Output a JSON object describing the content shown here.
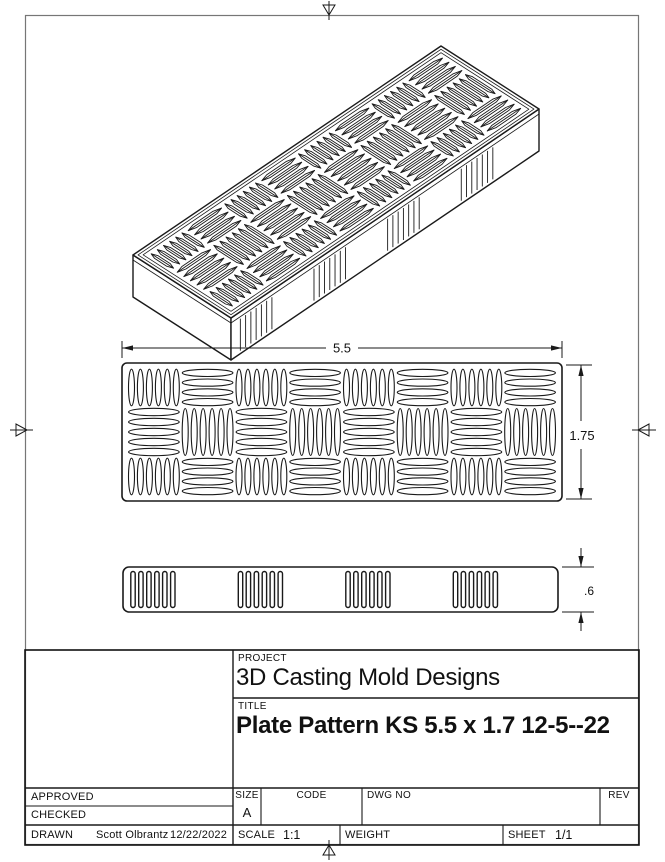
{
  "sheet": {
    "kind": "engineering-drawing",
    "line_color": "#1a1a1a",
    "frame_color": "#767676",
    "icons": {
      "centering_mark": "open-triangle-with-line"
    }
  },
  "drawing": {
    "dimensions": {
      "width": "5.5",
      "height": "1.75",
      "thickness": ".6"
    },
    "pattern": {
      "rows": 3,
      "cols": 8,
      "v_ellipses": 6,
      "h_ellipses_outer": 4,
      "h_ellipses_middle": 5,
      "side_slot_groups": [
        0,
        2,
        4,
        6
      ],
      "slots_per_group": 6,
      "iso_slot_lines": 7
    }
  },
  "title_block": {
    "project_label": "PROJECT",
    "project": "3D Casting Mold Designs",
    "title_label": "TITLE",
    "title": "Plate Pattern KS 5.5 x 1.7 12-5--22",
    "approved_label": "APPROVED",
    "checked_label": "CHECKED",
    "drawn_label": "DRAWN",
    "drawn_by": "Scott Olbrantz",
    "drawn_date": "12/22/2022",
    "size_label": "SIZE",
    "size": "A",
    "code_label": "CODE",
    "dwg_no_label": "DWG NO",
    "rev_label": "REV",
    "scale_label": "SCALE",
    "scale": "1:1",
    "weight_label": "WEIGHT",
    "sheet_label": "SHEET",
    "sheet": "1/1"
  }
}
